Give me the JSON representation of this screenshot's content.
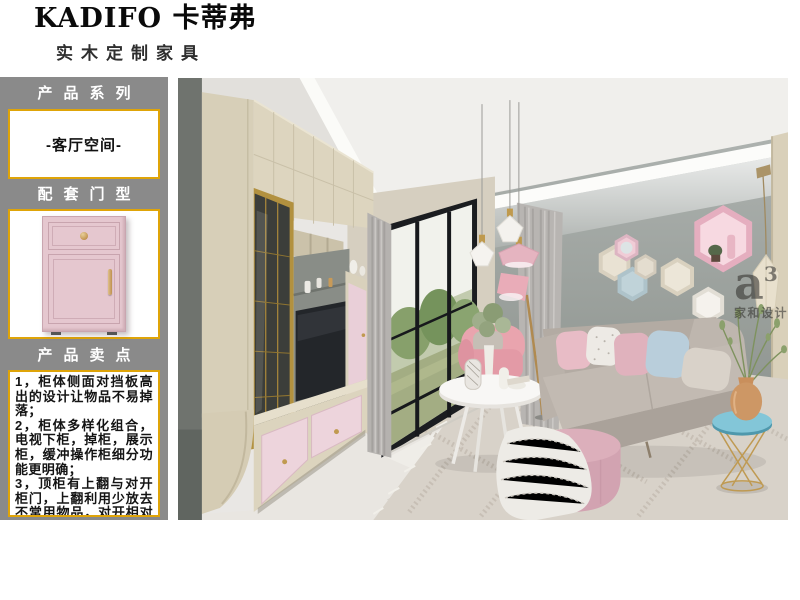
{
  "header": {
    "brand": "KADIFO 卡蒂弗",
    "subtitle": "实木定制家具"
  },
  "sidebar": {
    "series_label": "产品系列",
    "series_value": "-客厅空间-",
    "door_label": "配套门型",
    "door_image": "pink-shaker-cabinet-door-with-drawer",
    "points_label": "产品卖点",
    "points": [
      "1，柜体侧面对挡板高出的设计让物品不易掉落；",
      "2，柜体多样化组合，电视下柜，掉柜，展示柜，缓冲操作柜细分功能更明确；",
      "3，顶柜有上翻与对开柜门，上翻利用少放去不常用物品，对开相对会方便，可增加利用率；"
    ]
  },
  "photo": {
    "scene": "pink-and-grey-living-room-render",
    "watermark": {
      "logo": "a",
      "sup": "3",
      "caption": "家和设计"
    }
  },
  "colors": {
    "sidebar_bg": "#8a8a8a",
    "gold_border": "#dfa408",
    "door_pink": "#e5c7cf",
    "accent_wall_grey": "#9aa09d",
    "cabinet_cream": "#ddd5bf",
    "drawer_pink": "#ecd3da",
    "sofa_grey": "#b9b1a9"
  }
}
